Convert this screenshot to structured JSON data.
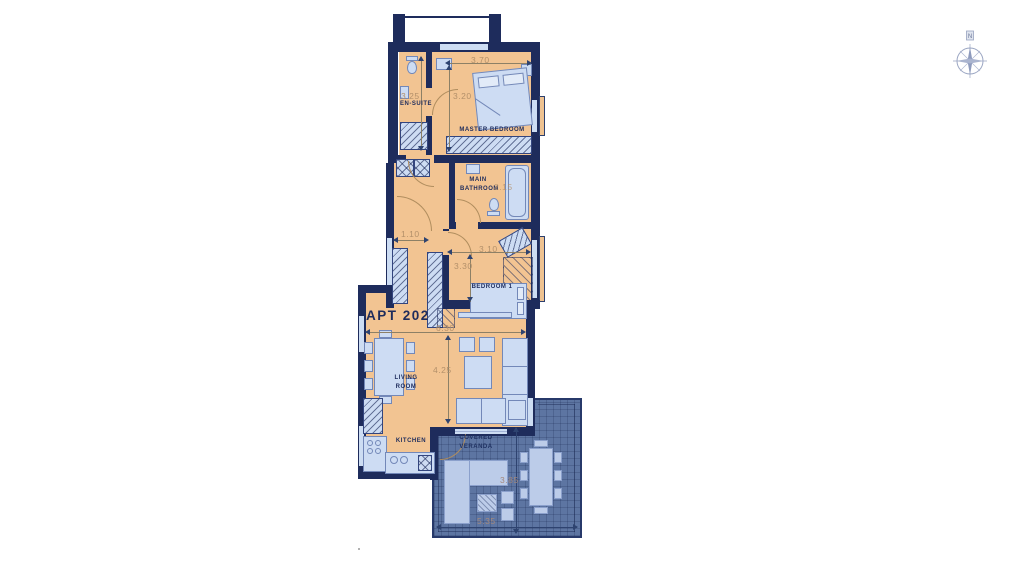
{
  "apartment": {
    "label": "APT 202"
  },
  "compass": {
    "label": "N"
  },
  "rooms": {
    "en_suite": {
      "label": "EN-SUITE",
      "dim_depth": "3.25"
    },
    "master_bedroom": {
      "label": "MASTER BEDROOM",
      "dim_width": "3.70",
      "dim_depth": "3.20"
    },
    "main_bathroom": {
      "label": "MAIN BATHROOM",
      "dim_width": "2.15"
    },
    "hallway": {
      "dim_width": "1.10"
    },
    "bedroom_1": {
      "label": "BEDROOM 1",
      "dim_width": "3.10",
      "dim_depth": "3.30"
    },
    "living_room": {
      "label": "LIVING ROOM",
      "dim_width": "6.30",
      "dim_depth": "4.25"
    },
    "kitchen": {
      "label": "KITCHEN"
    },
    "covered_veranda": {
      "label": "COVERED VERANDA",
      "dim_width": "5.35",
      "dim_depth": "3.85"
    }
  },
  "colors": {
    "wall": "#1e2c5c",
    "floor": "#f2c492",
    "furniture": "#cddcf3",
    "furniture_outline": "#7388b8",
    "veranda_floor": "#5d75a2",
    "veranda_furniture": "#bccce9",
    "dimension_text": "#b3906a",
    "label_text": "#1e2c5c"
  }
}
